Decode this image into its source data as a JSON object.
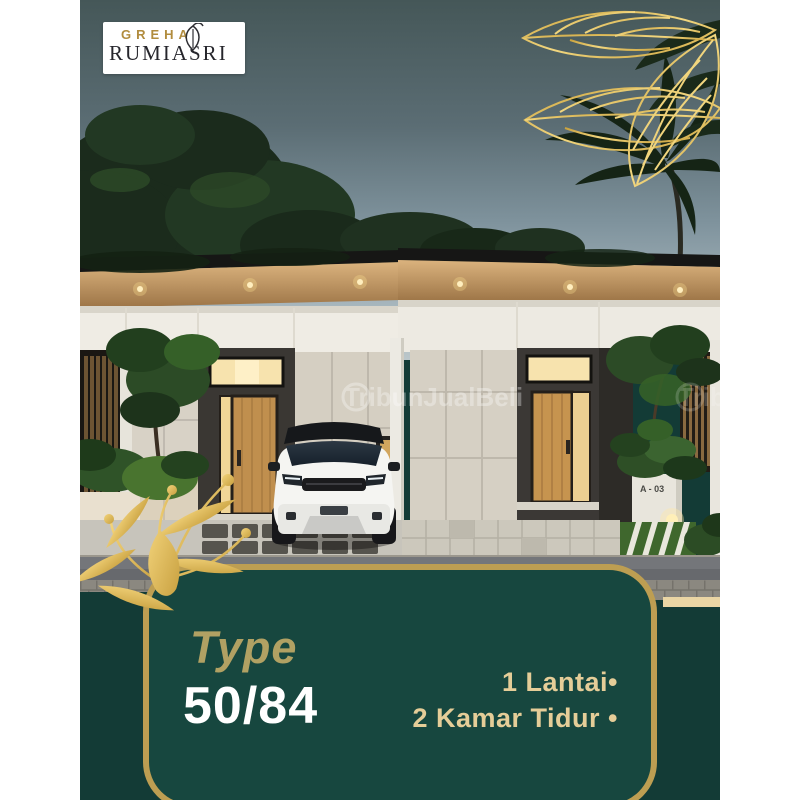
{
  "poster": {
    "colors": {
      "canvas_white": "#ffffff",
      "green_outer": "#133b36",
      "green_panel": "#17473f",
      "gold_border": "#bd9e52",
      "gold_decoration": "#e5c36a",
      "cream_strip": "#ead5a4",
      "type_gold": "#b1a163",
      "feature_text": "#e5cd98"
    }
  },
  "logo": {
    "brand_top": "GREHA",
    "brand_main": "RUMIASRI",
    "leaf_icon": "leaf-outline"
  },
  "photo": {
    "watermark": "TribunJualBeli",
    "house_unit_label": "A - 03"
  },
  "panel": {
    "type_label": "Type",
    "type_value": "50/84",
    "features": [
      "1 Lantai•",
      "2 Kamar Tidur •"
    ]
  }
}
